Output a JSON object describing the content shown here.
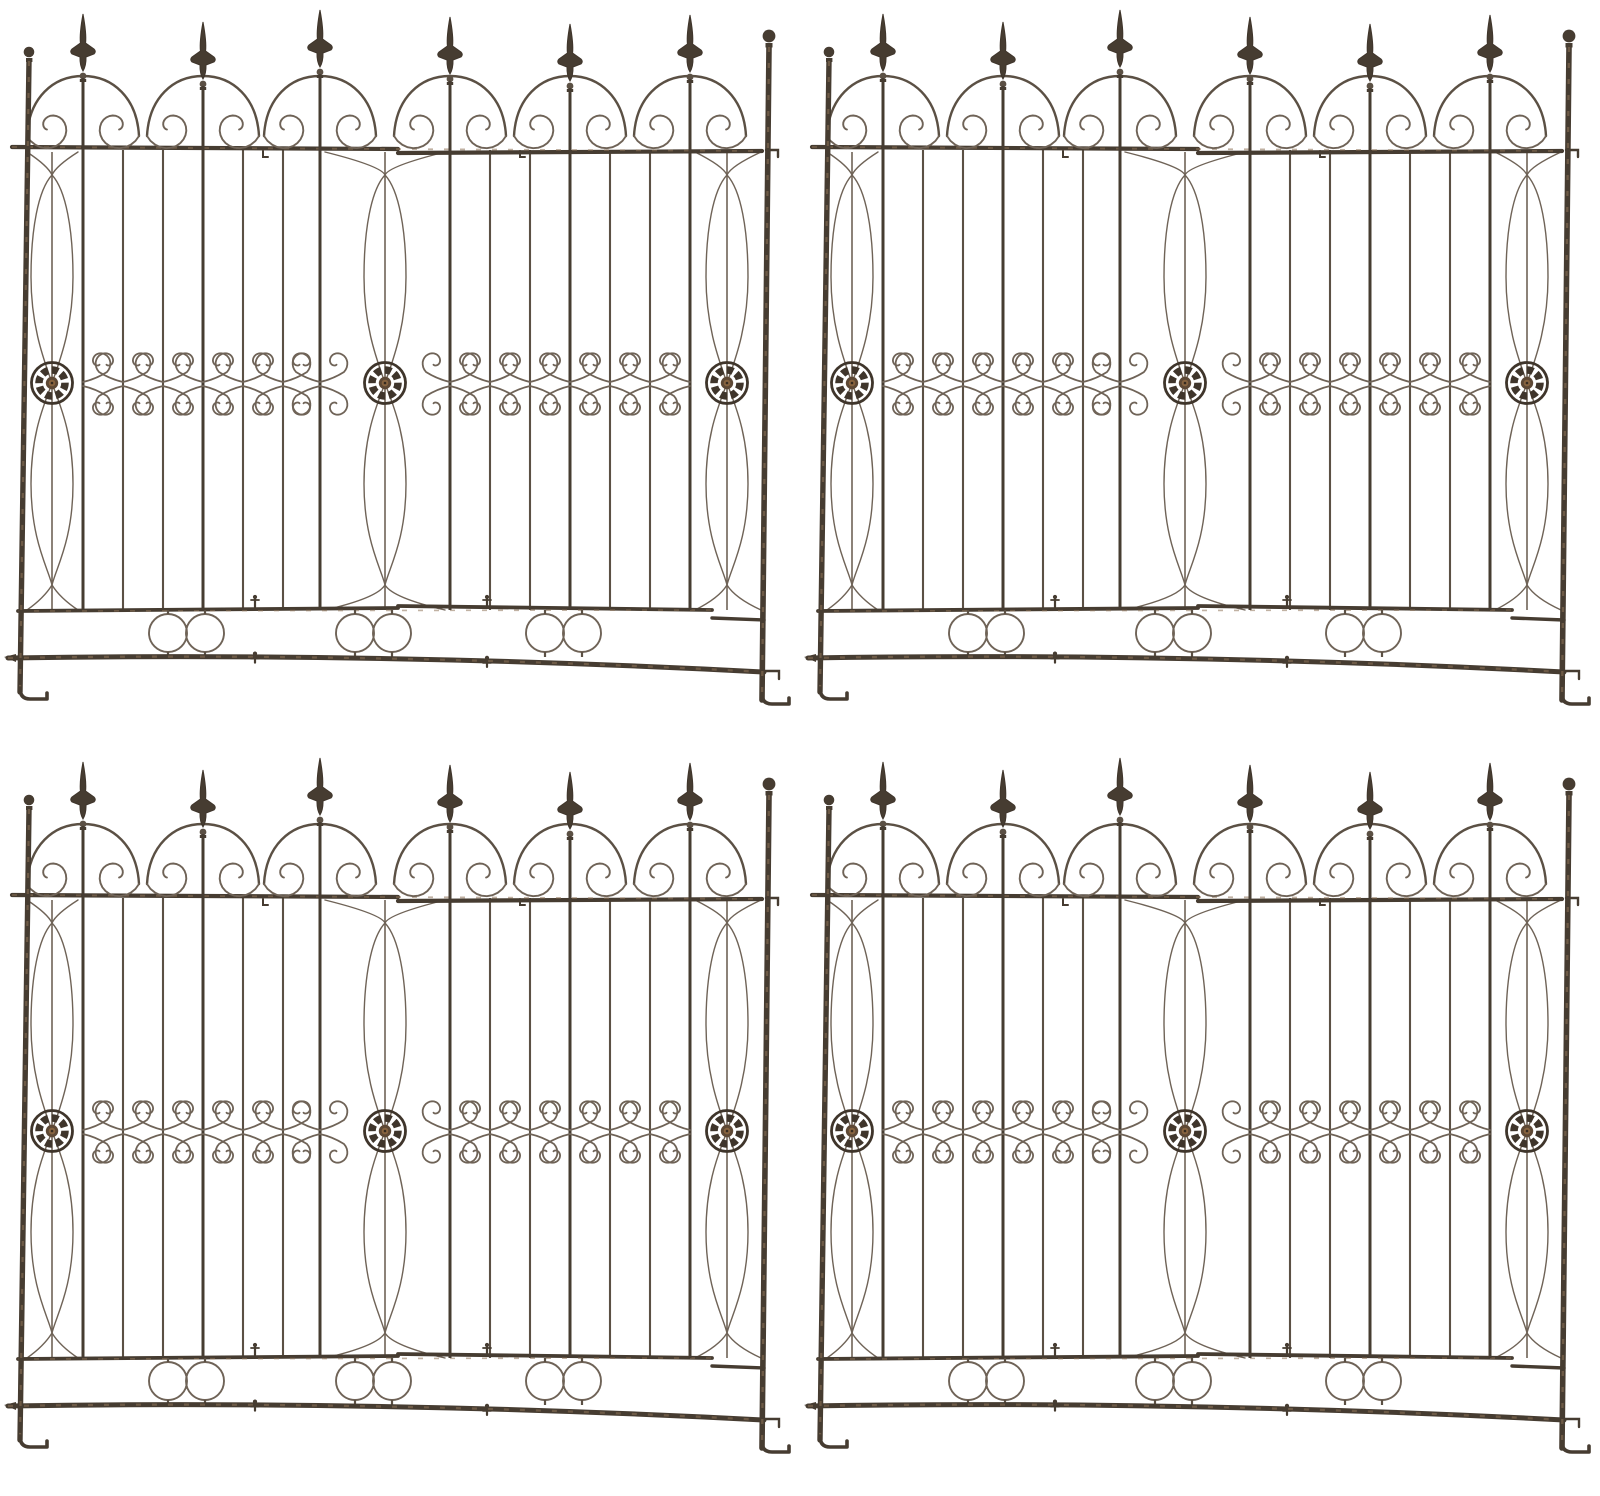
{
  "image": {
    "kind": "product-photo",
    "background": "#ffffff",
    "alt": "Four identical antique-style wrought iron garden fence trellis panels with spear-top finials, scrollwork arches, rosette medallions and ground stakes, arranged in a two by two grid on a white background"
  },
  "palette": {
    "dark": "#463c31",
    "mid": "#5b5044",
    "light": "#6f6357",
    "rust": "#8e7357",
    "rosette": "#3f352b",
    "boss_outer": "#5d4835",
    "boss_inner": "#87633f",
    "boss_dot": "#352a20"
  },
  "panels": [
    {
      "name": "fence-panel-1"
    },
    {
      "name": "fence-panel-2"
    },
    {
      "name": "fence-panel-3"
    },
    {
      "name": "fence-panel-4"
    }
  ],
  "structure": {
    "finial_count": 6,
    "rosette_count": 3,
    "ring_pair_count": 3,
    "post_left_x": 22,
    "post_right_x": 766,
    "finial_xs": [
      83,
      203,
      320,
      450,
      570,
      690
    ],
    "finial_tip_jitter": [
      6,
      14,
      2,
      9,
      16,
      7
    ],
    "plain_bar_xs": [
      123,
      163,
      243,
      283,
      490,
      530,
      610,
      650
    ],
    "half_butterfly": {
      "83": "right",
      "690": "left"
    },
    "lens_columns": [
      {
        "x1": 22,
        "x2": 83,
        "cx": 52
      },
      {
        "x1": 320,
        "x2": 450,
        "cx": 385
      },
      {
        "x1": 690,
        "x2": 766,
        "cx": 727
      }
    ],
    "rosette_y": 383,
    "mid_y": 384,
    "top_rail_y": 148,
    "rail_split_x": 398,
    "grid_bottom_y": 610,
    "ring_pairs": [
      [
        168,
        205
      ],
      [
        355,
        392
      ],
      [
        545,
        582
      ]
    ],
    "ring_cy": 633,
    "ring_r": 19,
    "pin_xs": [
      255,
      487
    ],
    "bracket_xs": [
      263,
      520
    ]
  }
}
